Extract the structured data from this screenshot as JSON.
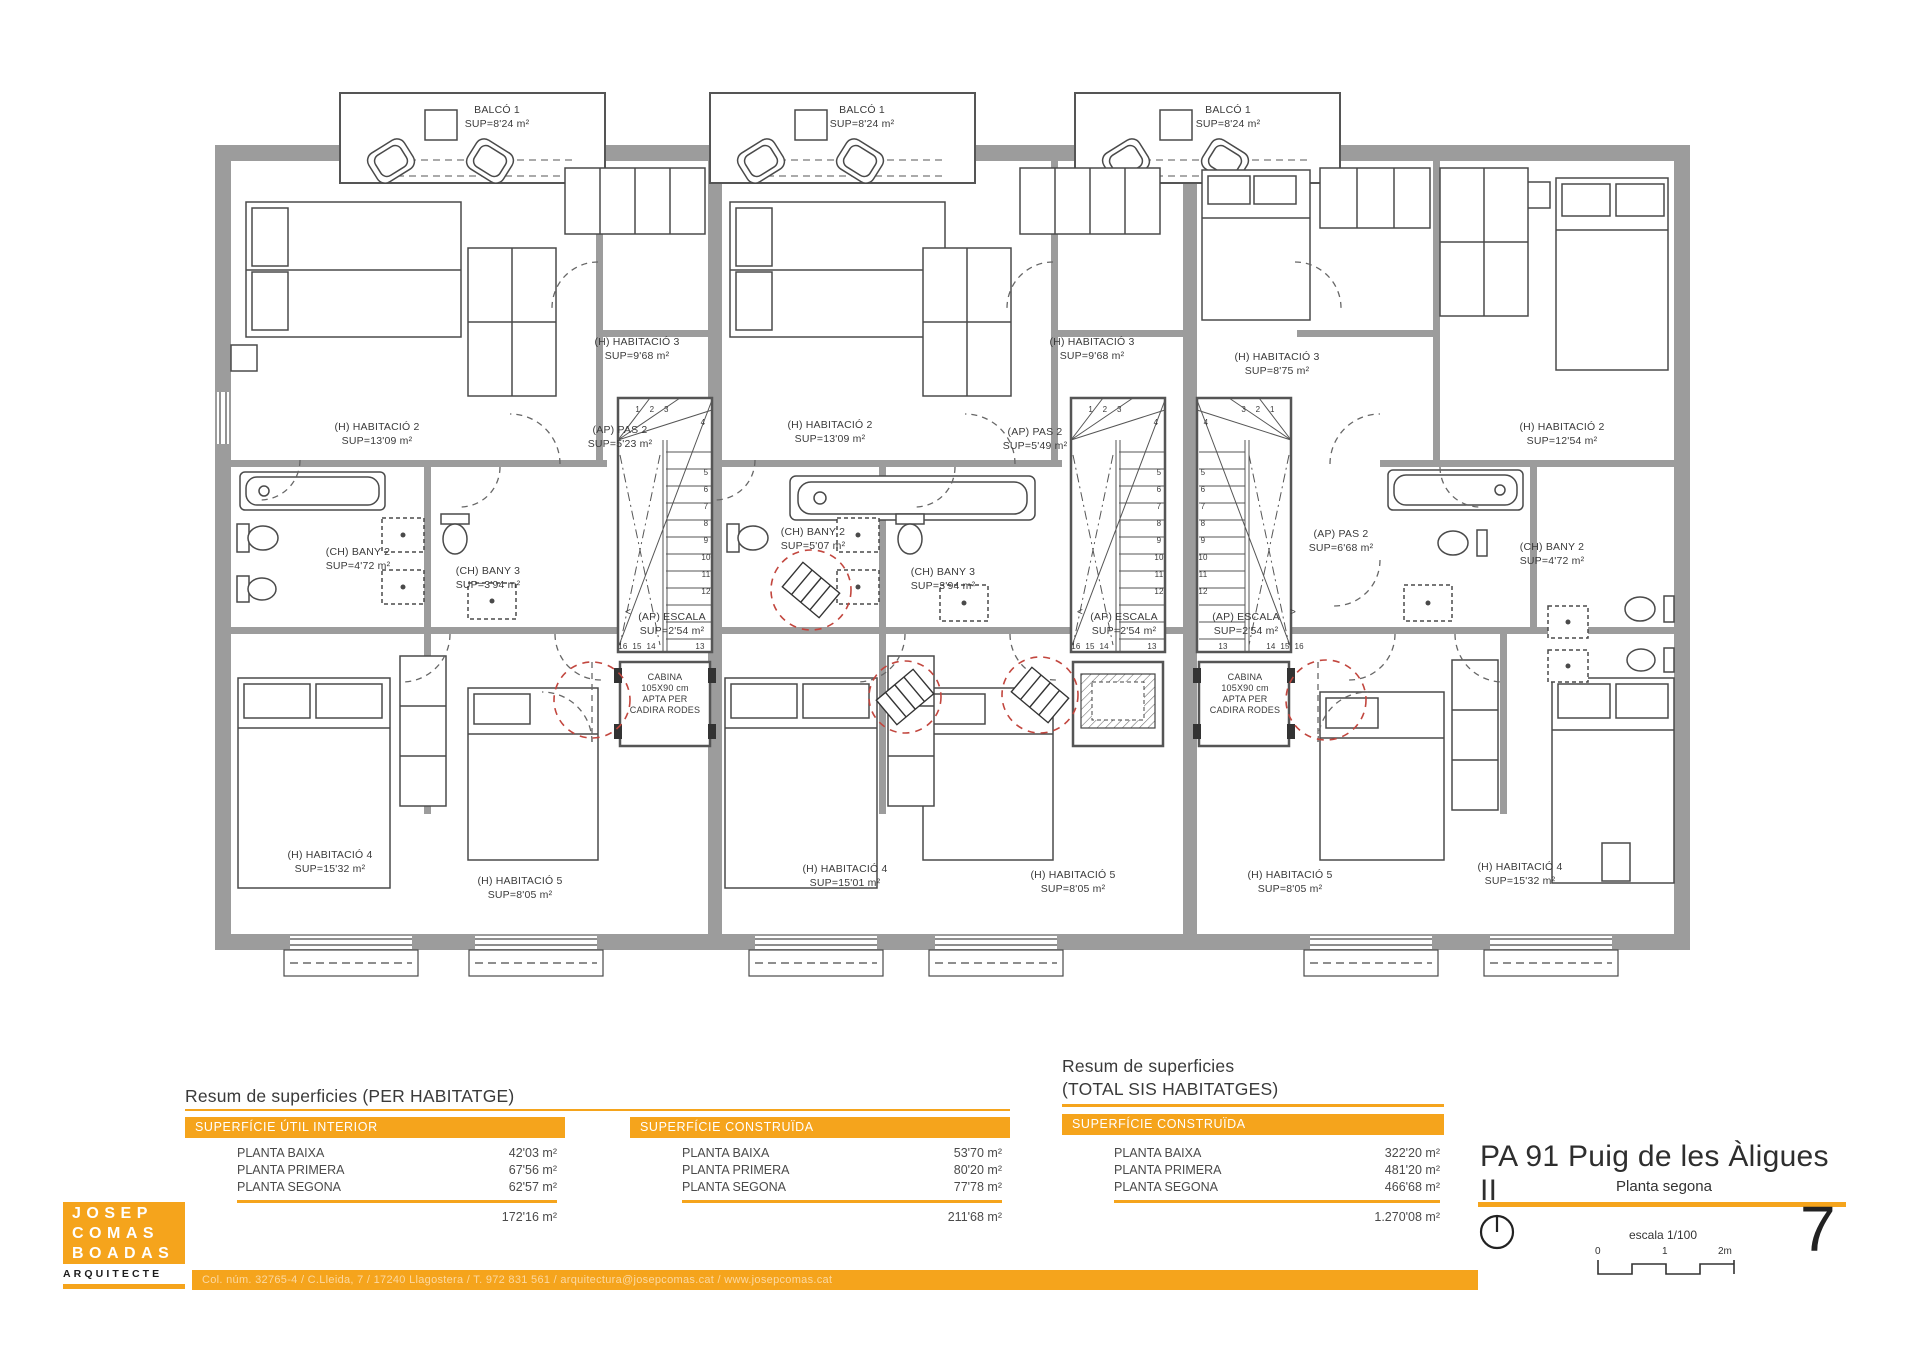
{
  "colors": {
    "accent": "#F5A41C",
    "wall": "#9C9C9C",
    "red_circle": "#C2463E",
    "line": "#4a4a4a"
  },
  "meta": {
    "sheet_title": "PA 91 Puig de les Àligues II",
    "sheet_subtitle": "Planta segona",
    "page_number": "7",
    "scale_label": "escala 1/100",
    "scale_ticks": [
      "0",
      "1",
      "2m"
    ]
  },
  "logo": {
    "line1": "JOSEP",
    "line2": "COMAS",
    "line3": "BOADAS",
    "tagline": "ARQUITECTE"
  },
  "footer": {
    "text": "Col. núm. 32765-4 / C.Lleida, 7 / 17240 Llagostera / T. 972 831 561 / arquitectura@josepcomas.cat / www.josepcomas.cat"
  },
  "summary_left": {
    "heading": "Resum de superficies (PER HABITATGE)",
    "tables": [
      {
        "header": "SUPERFÍCIE ÚTIL INTERIOR",
        "rows": [
          {
            "label": "PLANTA BAIXA",
            "value": "42'03 m²"
          },
          {
            "label": "PLANTA PRIMERA",
            "value": "67'56 m²"
          },
          {
            "label": "PLANTA SEGONA",
            "value": "62'57 m²"
          }
        ],
        "total": "172'16 m²"
      },
      {
        "header": "SUPERFÍCIE CONSTRUÏDA",
        "rows": [
          {
            "label": "PLANTA BAIXA",
            "value": "53'70 m²"
          },
          {
            "label": "PLANTA PRIMERA",
            "value": "80'20 m²"
          },
          {
            "label": "PLANTA SEGONA",
            "value": "77'78 m²"
          }
        ],
        "total": "211'68 m²"
      }
    ]
  },
  "summary_right": {
    "heading_line1": "Resum de superficies",
    "heading_line2": "(TOTAL SIS HABITATGES)",
    "table": {
      "header": "SUPERFÍCIE CONSTRUÏDA",
      "rows": [
        {
          "label": "PLANTA BAIXA",
          "value": "322'20 m²"
        },
        {
          "label": "PLANTA PRIMERA",
          "value": "481'20 m²"
        },
        {
          "label": "PLANTA SEGONA",
          "value": "466'68 m²"
        }
      ],
      "total": "1.270'08 m²"
    }
  },
  "plan": {
    "labels": [
      {
        "name": "u1-balcony-label",
        "x": 497,
        "y": 104,
        "lines": [
          "BALCÓ 1",
          "SUP=8'24 m²"
        ]
      },
      {
        "name": "u2-balcony-label",
        "x": 862,
        "y": 104,
        "lines": [
          "BALCÓ 1",
          "SUP=8'24 m²"
        ]
      },
      {
        "name": "u3-balcony-label",
        "x": 1228,
        "y": 104,
        "lines": [
          "BALCÓ 1",
          "SUP=8'24 m²"
        ]
      },
      {
        "name": "u1-habitacio2-label",
        "x": 377,
        "y": 421,
        "lines": [
          "(H) HABITACIÓ 2",
          "SUP=13'09 m²"
        ]
      },
      {
        "name": "u1-habitacio3-label",
        "x": 637,
        "y": 336,
        "lines": [
          "(H) HABITACIÓ 3",
          "SUP=9'68 m²"
        ]
      },
      {
        "name": "u1-pas2-label",
        "x": 620,
        "y": 424,
        "lines": [
          "(AP) PAS 2",
          "SUP=5'23 m²"
        ]
      },
      {
        "name": "u1-bany2-label",
        "x": 358,
        "y": 546,
        "lines": [
          "(CH) BANY 2",
          "SUP=4'72 m²"
        ]
      },
      {
        "name": "u1-bany3-label",
        "x": 488,
        "y": 565,
        "lines": [
          "(CH) BANY 3",
          "SUP=3'94 m²"
        ]
      },
      {
        "name": "u1-escala-label",
        "x": 672,
        "y": 611,
        "lines": [
          "(AP) ESCALA",
          "SUP=2'54 m²"
        ]
      },
      {
        "name": "u1-cabina-label",
        "x": 665,
        "y": 672,
        "size": 9,
        "lh": 11,
        "lines": [
          "CABINA",
          "105X90 cm",
          "APTA PER",
          "CADIRA RODES"
        ]
      },
      {
        "name": "u1-habitacio4-label",
        "x": 330,
        "y": 849,
        "lines": [
          "(H) HABITACIÓ 4",
          "SUP=15'32 m²"
        ]
      },
      {
        "name": "u1-habitacio5-label",
        "x": 520,
        "y": 875,
        "lines": [
          "(H) HABITACIÓ 5",
          "SUP=8'05 m²"
        ]
      },
      {
        "name": "u2-habitacio2-label",
        "x": 830,
        "y": 419,
        "lines": [
          "(H) HABITACIÓ 2",
          "SUP=13'09 m²"
        ]
      },
      {
        "name": "u2-habitacio3-label",
        "x": 1092,
        "y": 336,
        "lines": [
          "(H) HABITACIÓ 3",
          "SUP=9'68 m²"
        ]
      },
      {
        "name": "u2-pas2-label",
        "x": 1035,
        "y": 426,
        "lines": [
          "(AP) PAS 2",
          "SUP=5'49 m²"
        ]
      },
      {
        "name": "u2-bany2-label",
        "x": 813,
        "y": 526,
        "lines": [
          "(CH) BANY 2",
          "SUP=5'07 m²"
        ]
      },
      {
        "name": "u2-bany3-label",
        "x": 943,
        "y": 566,
        "lines": [
          "(CH) BANY 3",
          "SUP=3'94 m²"
        ]
      },
      {
        "name": "u2-escala-label",
        "x": 1124,
        "y": 611,
        "lines": [
          "(AP) ESCALA",
          "SUP=2'54 m²"
        ]
      },
      {
        "name": "u2-habitacio4-label",
        "x": 845,
        "y": 863,
        "lines": [
          "(H) HABITACIÓ 4",
          "SUP=15'01 m²"
        ]
      },
      {
        "name": "u2-habitacio5-label",
        "x": 1073,
        "y": 869,
        "lines": [
          "(H) HABITACIÓ 5",
          "SUP=8'05 m²"
        ]
      },
      {
        "name": "u3-habitacio2-label",
        "x": 1562,
        "y": 421,
        "lines": [
          "(H) HABITACIÓ 2",
          "SUP=12'54 m²"
        ]
      },
      {
        "name": "u3-habitacio3-label",
        "x": 1277,
        "y": 351,
        "lines": [
          "(H) HABITACIÓ 3",
          "SUP=8'75 m²"
        ]
      },
      {
        "name": "u3-pas2-label",
        "x": 1341,
        "y": 528,
        "lines": [
          "(AP) PAS 2",
          "SUP=6'68 m²"
        ]
      },
      {
        "name": "u3-bany2-label",
        "x": 1552,
        "y": 541,
        "lines": [
          "(CH) BANY 2",
          "SUP=4'72 m²"
        ]
      },
      {
        "name": "u3-escala-label",
        "x": 1246,
        "y": 611,
        "lines": [
          "(AP) ESCALA",
          "SUP=2'54 m²"
        ]
      },
      {
        "name": "u3-cabina-label",
        "x": 1245,
        "y": 672,
        "size": 9,
        "lh": 11,
        "lines": [
          "CABINA",
          "105X90 cm",
          "APTA PER",
          "CADIRA RODES"
        ]
      },
      {
        "name": "u3-habitacio5-label",
        "x": 1290,
        "y": 869,
        "lines": [
          "(H) HABITACIÓ 5",
          "SUP=8'05 m²"
        ]
      },
      {
        "name": "u3-habitacio4-label",
        "x": 1520,
        "y": 861,
        "lines": [
          "(H) HABITACIÓ 4",
          "SUP=15'32 m²"
        ]
      },
      {
        "name": "u1-stair-numbers-top",
        "x": 652,
        "y": 403,
        "size": 8,
        "lines": [
          "1    2    3"
        ]
      },
      {
        "name": "u1-stair-number-4",
        "x": 703,
        "y": 416,
        "size": 8,
        "lines": [
          "4"
        ]
      },
      {
        "name": "u1-stair-numbers-side",
        "x": 706,
        "y": 464,
        "size": 8,
        "lh": 17,
        "lines": [
          "5",
          "6",
          "7",
          "8",
          "9",
          "10",
          "11",
          "12"
        ]
      },
      {
        "name": "u1-stair-numbers-bottom",
        "x": 637,
        "y": 640,
        "size": 8,
        "lines": [
          "16  15  14"
        ]
      },
      {
        "name": "u1-stair-number-13",
        "x": 700,
        "y": 640,
        "size": 8,
        "lines": [
          "13"
        ]
      },
      {
        "name": "u2-stair-numbers-top",
        "x": 1105,
        "y": 403,
        "size": 8,
        "lines": [
          "1    2    3"
        ]
      },
      {
        "name": "u2-stair-number-4",
        "x": 1156,
        "y": 416,
        "size": 8,
        "lines": [
          "4"
        ]
      },
      {
        "name": "u2-stair-numbers-side",
        "x": 1159,
        "y": 464,
        "size": 8,
        "lh": 17,
        "lines": [
          "5",
          "6",
          "7",
          "8",
          "9",
          "10",
          "11",
          "12"
        ]
      },
      {
        "name": "u2-stair-numbers-bottom",
        "x": 1090,
        "y": 640,
        "size": 8,
        "lines": [
          "16  15  14"
        ]
      },
      {
        "name": "u2-stair-number-13",
        "x": 1152,
        "y": 640,
        "size": 8,
        "lines": [
          "13"
        ]
      },
      {
        "name": "u3-stair-numbers-top",
        "x": 1258,
        "y": 403,
        "size": 8,
        "lines": [
          "3    2    1"
        ]
      },
      {
        "name": "u3-stair-number-4",
        "x": 1206,
        "y": 416,
        "size": 8,
        "lines": [
          "4"
        ]
      },
      {
        "name": "u3-stair-numbers-side",
        "x": 1203,
        "y": 464,
        "size": 8,
        "lh": 17,
        "lines": [
          "5",
          "6",
          "7",
          "8",
          "9",
          "10",
          "11",
          "12"
        ]
      },
      {
        "name": "u3-stair-number-13",
        "x": 1223,
        "y": 640,
        "size": 8,
        "lines": [
          "13"
        ]
      },
      {
        "name": "u3-stair-numbers-bottom",
        "x": 1285,
        "y": 640,
        "size": 8,
        "lines": [
          "14  15  16"
        ]
      },
      {
        "name": "u1-stair-direction-arrow",
        "x": 628,
        "y": 606,
        "size": 10,
        "lines": [
          "<"
        ]
      },
      {
        "name": "u2-stair-direction-arrow",
        "x": 1080,
        "y": 606,
        "size": 10,
        "lines": [
          "<"
        ]
      },
      {
        "name": "u3-stair-direction-arrow",
        "x": 1293,
        "y": 606,
        "size": 10,
        "lines": [
          ">"
        ]
      }
    ]
  }
}
